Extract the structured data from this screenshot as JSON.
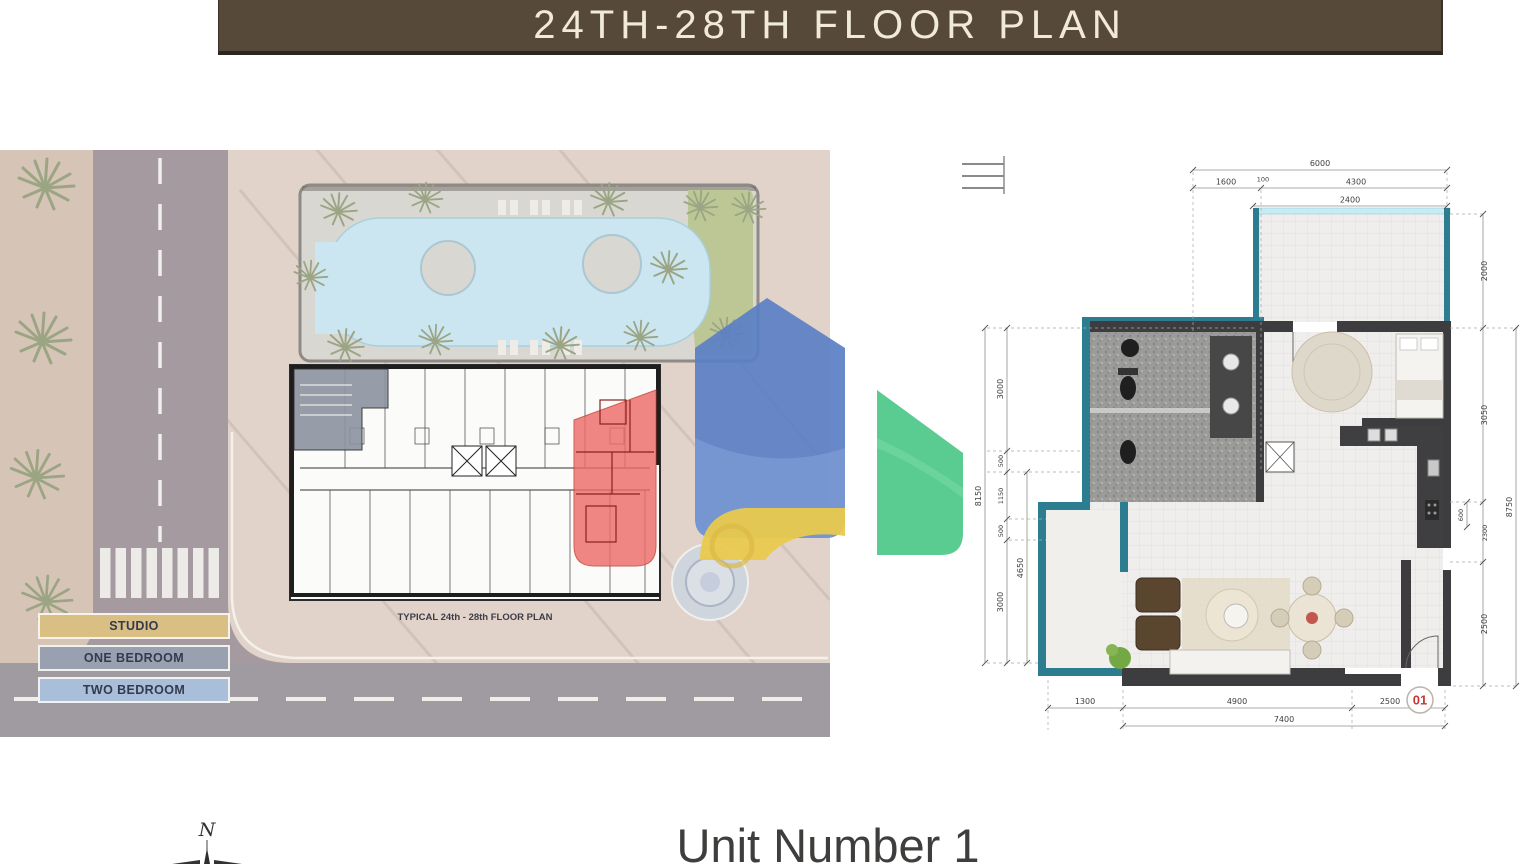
{
  "title_bar": {
    "text": "24TH-28TH FLOOR PLAN",
    "bg_color": "#57493a",
    "text_color": "#f2ead9"
  },
  "site_plan": {
    "caption": "TYPICAL 24th - 28th FLOOR PLAN",
    "legend": [
      {
        "label": "STUDIO",
        "color": "#d9bf83"
      },
      {
        "label": "ONE BEDROOM",
        "color": "#99a1b1"
      },
      {
        "label": "TWO BEDROOM",
        "color": "#a9bed8"
      }
    ],
    "highlight_unit_color": "#ee6a66"
  },
  "unit_plan": {
    "unit_badge": "01",
    "wall_color": "#2d7d91",
    "dims": {
      "top": [
        "6000",
        "1600",
        "100",
        "4300",
        "2400"
      ],
      "left": [
        "3000",
        "500",
        "1150",
        "500",
        "3000",
        "8150",
        "4650"
      ],
      "right": [
        "2000",
        "3050",
        "600",
        "2300",
        "2500",
        "8750"
      ],
      "bottom": [
        "1300",
        "4900",
        "2500",
        "7400"
      ]
    }
  },
  "footer": {
    "unit_title": "Unit Number 1",
    "compass_north": "N"
  },
  "watermark": {
    "blue": "#5b7fc4",
    "yellow": "#e9c94e",
    "green": "#52c98b"
  }
}
